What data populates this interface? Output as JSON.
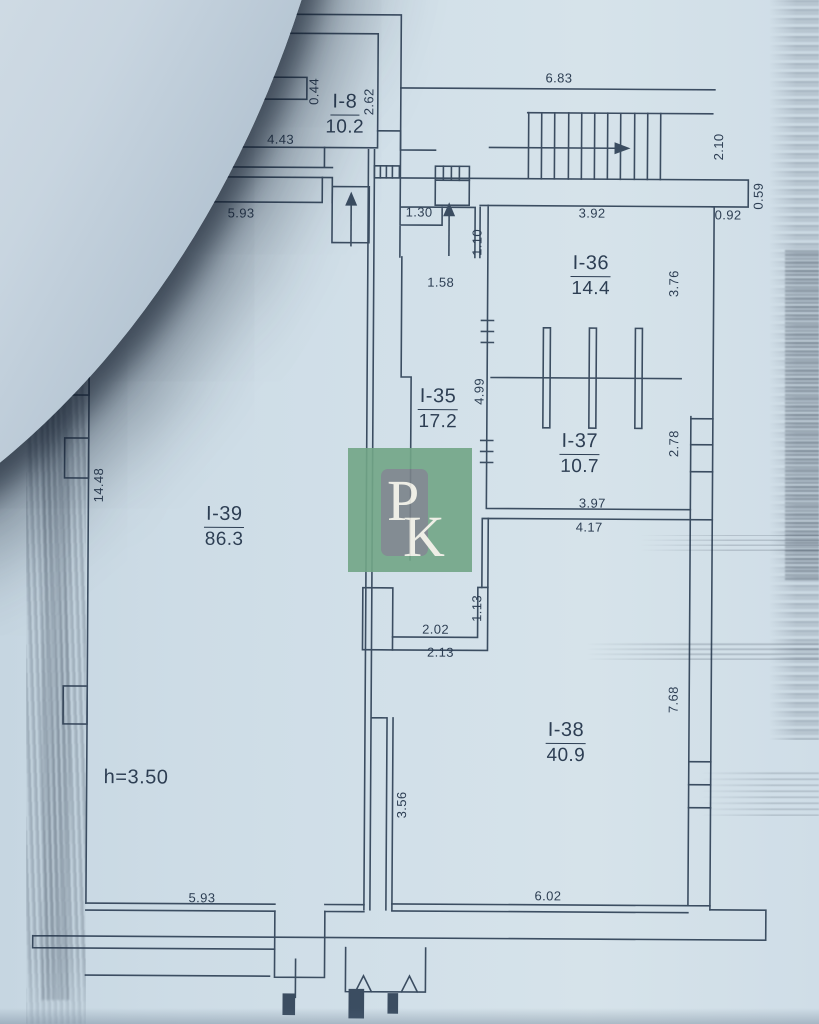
{
  "colors": {
    "paper": "#cfdde7",
    "ink": "#2d3e53"
  },
  "watermark": {
    "p": "P",
    "k": "K",
    "green": "#72a687",
    "gray": "#7b838a",
    "ink": "#f2f0e6"
  },
  "plan": {
    "note": "h=3.50",
    "rooms": [
      {
        "id": "I-8",
        "area": "10.2",
        "x": 342,
        "y": 91
      },
      {
        "id": "I-36",
        "area": "14.4",
        "x": 589,
        "y": 251
      },
      {
        "id": "I-35",
        "area": "17.2",
        "x": 437,
        "y": 385
      },
      {
        "id": "I-37",
        "area": "10.7",
        "x": 579,
        "y": 429
      },
      {
        "id": "I-39",
        "area": "86.3",
        "x": 224,
        "y": 504
      },
      {
        "id": "I-38",
        "area": "40.9",
        "x": 567,
        "y": 718
      }
    ],
    "dimensions": [
      {
        "t": "6.95",
        "x": 240,
        "y": 7
      },
      {
        "t": "2.88",
        "x": 240,
        "y": 72
      },
      {
        "t": "0.44",
        "x": 311,
        "y": 92,
        "v": true
      },
      {
        "t": "2.62",
        "x": 366,
        "y": 102,
        "v": true
      },
      {
        "t": "4.43",
        "x": 278,
        "y": 140
      },
      {
        "t": "6.83",
        "x": 556,
        "y": 77
      },
      {
        "t": "2.10",
        "x": 716,
        "y": 145,
        "v": true
      },
      {
        "t": "0.59",
        "x": 756,
        "y": 194,
        "v": true
      },
      {
        "t": "5.93",
        "x": 239,
        "y": 214
      },
      {
        "t": "1.30",
        "x": 417,
        "y": 212
      },
      {
        "t": "3.92",
        "x": 590,
        "y": 212
      },
      {
        "t": "0.92",
        "x": 726,
        "y": 213
      },
      {
        "t": "1.10",
        "x": 475,
        "y": 242,
        "v": true
      },
      {
        "t": "1.58",
        "x": 439,
        "y": 282
      },
      {
        "t": "3.76",
        "x": 672,
        "y": 282,
        "v": true
      },
      {
        "t": "4.99",
        "x": 478,
        "y": 391,
        "v": true
      },
      {
        "t": "2.78",
        "x": 673,
        "y": 442,
        "v": true
      },
      {
        "t": "14.48",
        "x": 98,
        "y": 487,
        "v": true
      },
      {
        "t": "3.97",
        "x": 592,
        "y": 502
      },
      {
        "t": "4.17",
        "x": 589,
        "y": 526
      },
      {
        "t": "1.13",
        "x": 477,
        "y": 608,
        "v": true
      },
      {
        "t": "2.02",
        "x": 436,
        "y": 629
      },
      {
        "t": "2.13",
        "x": 441,
        "y": 652
      },
      {
        "t": "7.68",
        "x": 674,
        "y": 698,
        "v": true
      },
      {
        "t": "3.56",
        "x": 403,
        "y": 805,
        "v": true
      },
      {
        "t": "5.93",
        "x": 204,
        "y": 899
      },
      {
        "t": "6.02",
        "x": 550,
        "y": 895
      }
    ]
  }
}
